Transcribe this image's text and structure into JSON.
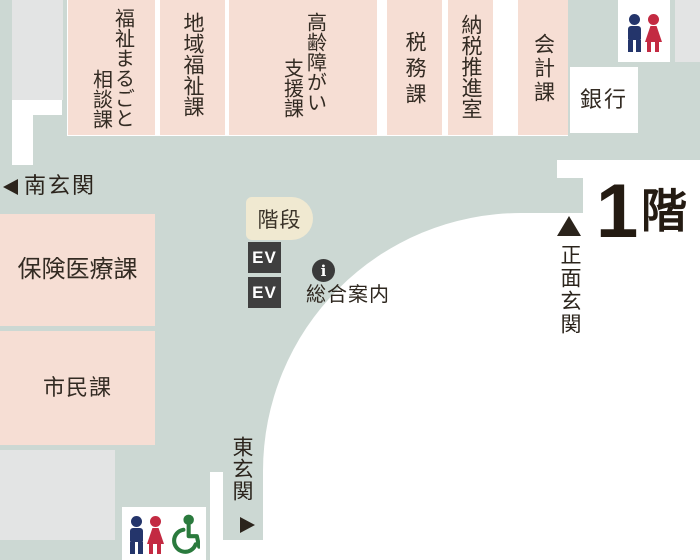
{
  "floor_label": {
    "number": "1",
    "suffix": "階"
  },
  "departments": {
    "welfare_marugoto_line1": "福祉まるごと",
    "welfare_marugoto_line2": "相談課",
    "regional_welfare": "地域福祉課",
    "elderly_disability_line1": "高齢障がい",
    "elderly_disability_line2": "支援課",
    "tax": "税務課",
    "tax_payment_promotion": "納税推進室",
    "accounting": "会計課",
    "bank": "銀行",
    "insurance_medical": "保険医療課",
    "citizen": "市民課"
  },
  "facilities": {
    "stairs": "階段",
    "elevator": "EV",
    "info_symbol": "i",
    "info_label": "総合案内"
  },
  "entrances": {
    "south": "南玄関",
    "main": "正面玄関",
    "east": "東玄関"
  },
  "colors": {
    "floor_sage": "#ccd8d3",
    "room_pink": "#f6ded4",
    "gray_block": "#e3e4e4",
    "stairs_cream": "#f0e9d1",
    "dark_box": "#3f3f3f",
    "text_dark": "#332b23",
    "man_blue": "#24356b",
    "woman_red": "#c32a42",
    "wheelchair_green": "#2a7a3d"
  }
}
